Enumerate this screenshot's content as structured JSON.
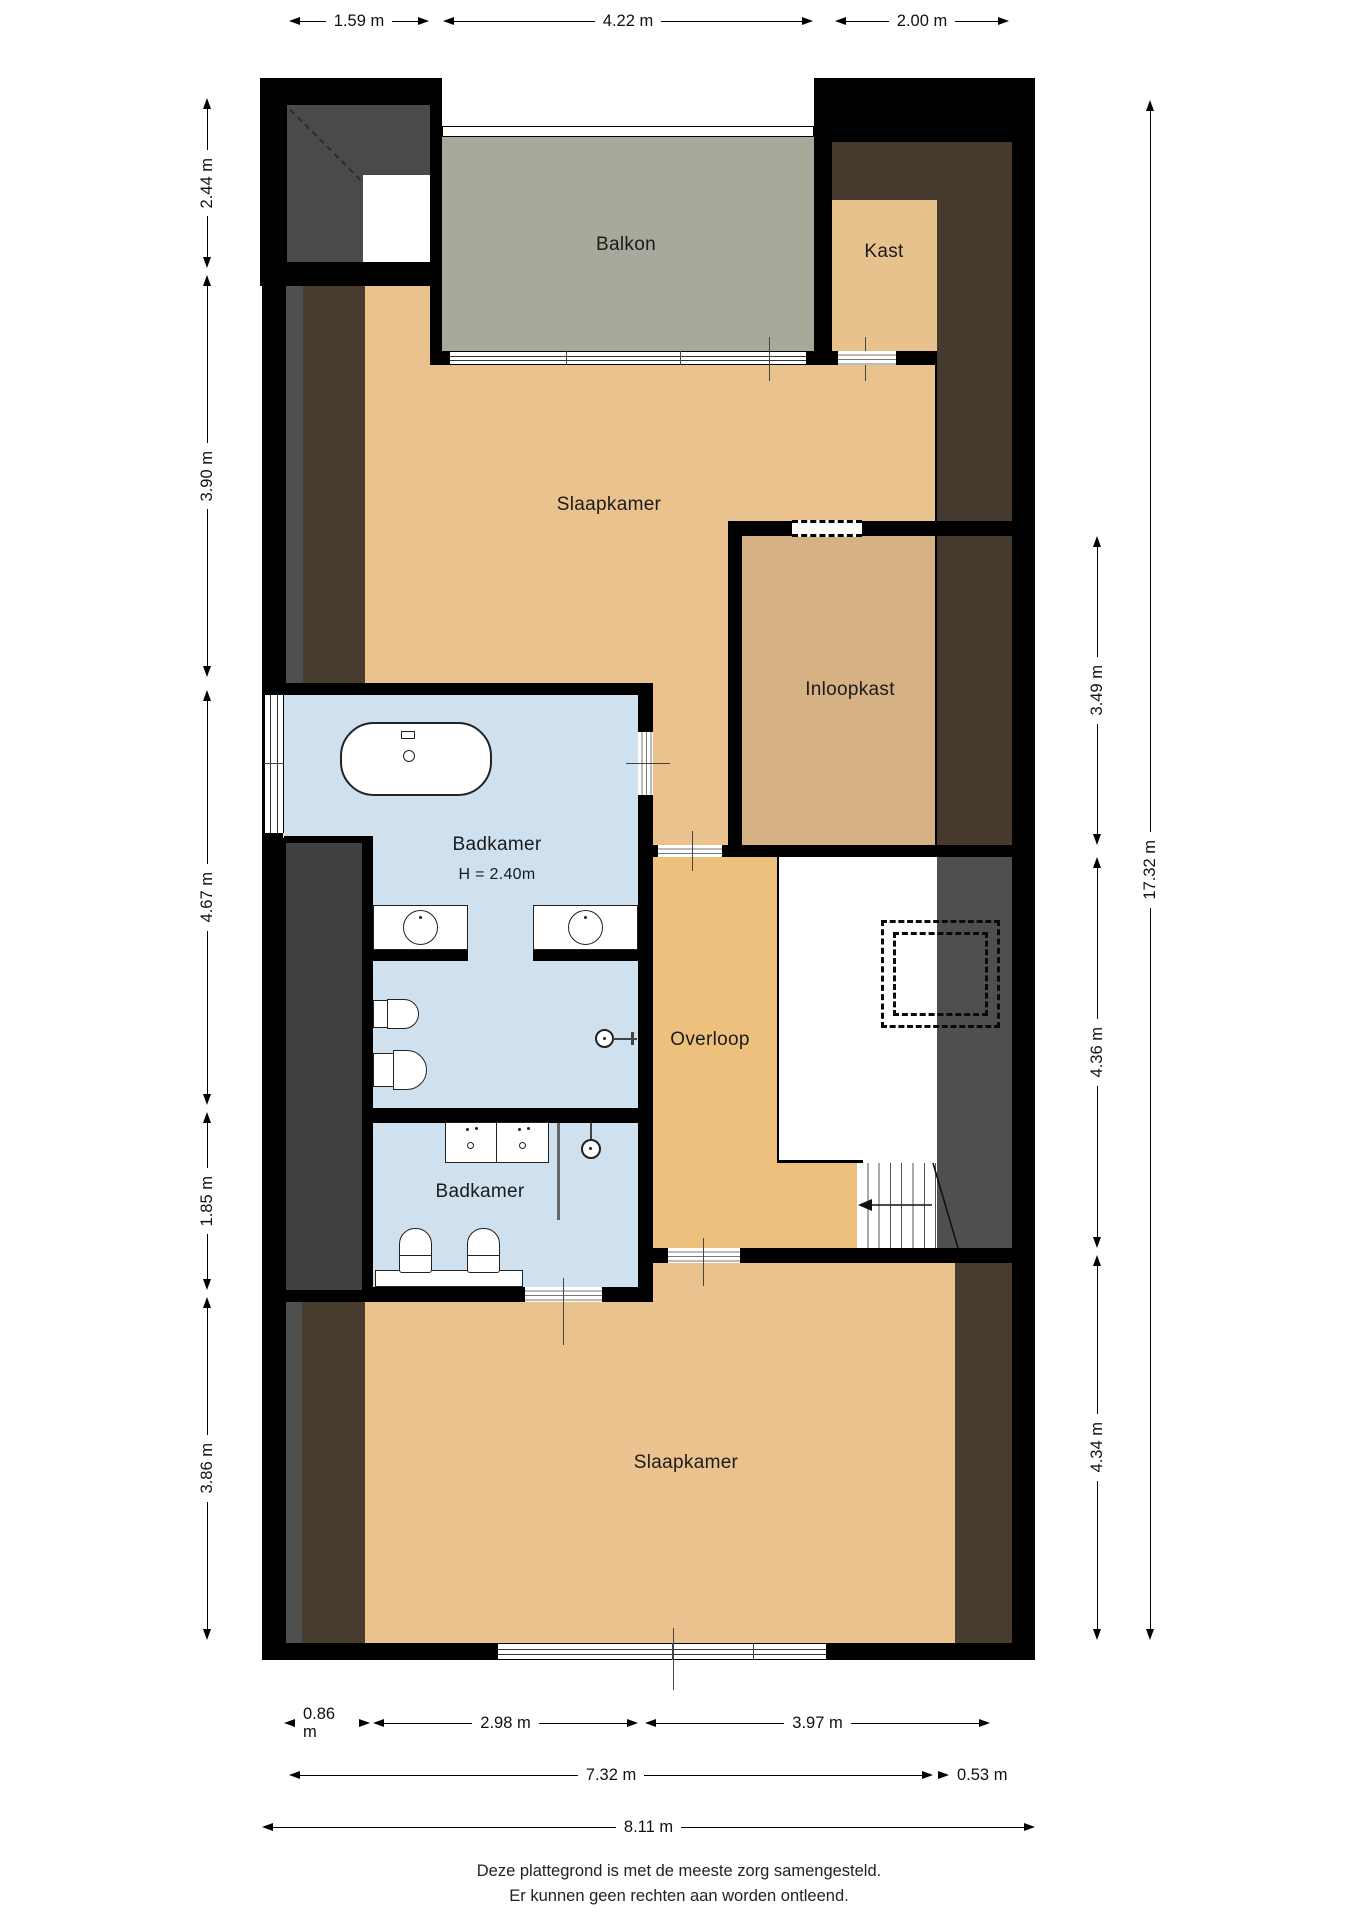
{
  "rooms": {
    "balkon": {
      "label": "Balkon"
    },
    "kast": {
      "label": "Kast"
    },
    "slaapkamer_top": {
      "label": "Slaapkamer"
    },
    "inloopkast": {
      "label": "Inloopkast"
    },
    "badkamer_main": {
      "label": "Badkamer",
      "height_note": "H = 2.40m"
    },
    "overloop": {
      "label": "Overloop"
    },
    "badkamer_second": {
      "label": "Badkamer"
    },
    "slaapkamer_bottom": {
      "label": "Slaapkamer"
    }
  },
  "dimensions": {
    "top": [
      "1.59 m",
      "4.22 m",
      "2.00 m"
    ],
    "left": [
      "2.44 m",
      "3.90 m",
      "4.67 m",
      "1.85 m",
      "3.86 m"
    ],
    "right": [
      "3.49 m",
      "4.36 m",
      "4.34 m"
    ],
    "right_total": "17.32 m",
    "bottom_row1": [
      "0.86 m",
      "2.98 m",
      "3.97 m"
    ],
    "bottom_row2": [
      "7.32 m",
      "0.53 m"
    ],
    "bottom_total": "8.11 m"
  },
  "footer": {
    "line1": "Deze plattegrond is met de meeste zorg samengesteld.",
    "line2": "Er kunnen geen rechten aan worden ontleend."
  },
  "colors": {
    "wall": "#000000",
    "floor_tan": "#e9c28e",
    "floor_overloop": "#eec07e",
    "floor_inloopkast": "#d6b184",
    "floor_bathroom": "#cfe0ee",
    "balcony": "#a7a99b",
    "roof_dark_brown": "#483c2f",
    "roof_dark_gray": "#474747"
  }
}
